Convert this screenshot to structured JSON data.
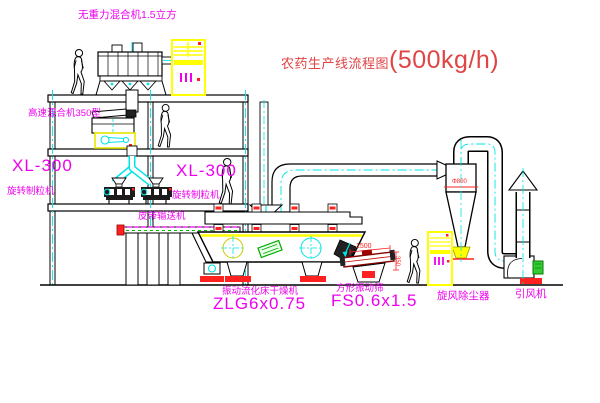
{
  "diagram": {
    "title": {
      "text": "农药生产线流程图",
      "capacity": "(500kg/h)"
    },
    "labels": {
      "gravity_mixer": "无重力混合机1.5立方",
      "high_speed_mixer": "高速混合机350型",
      "granulator_left_model": "XL-300",
      "granulator_left_name": "旋转制粒机",
      "granulator_right_model": "XL-300",
      "granulator_right_name": "旋转制粒机",
      "belt_conveyor": "皮带输送机",
      "dryer_name": "振动流化床干燥机",
      "dryer_model": "ZLG6x0.75",
      "screen_name": "方形振动筛",
      "screen_model": "FS0.6x1.5",
      "cyclone": "旋风除尘器",
      "fan": "引风机"
    },
    "dimensions": {
      "screen_length": "1500",
      "cyclone_dia": "Φ800",
      "screen_height": "350"
    },
    "colors": {
      "label_magenta": "#ee00ee",
      "title_red": "#e04444",
      "centerline_cyan": "#00e5e5",
      "accent_yellow": "#ffff00",
      "accent_red": "#ff0000",
      "accent_green": "#00aa00"
    }
  }
}
